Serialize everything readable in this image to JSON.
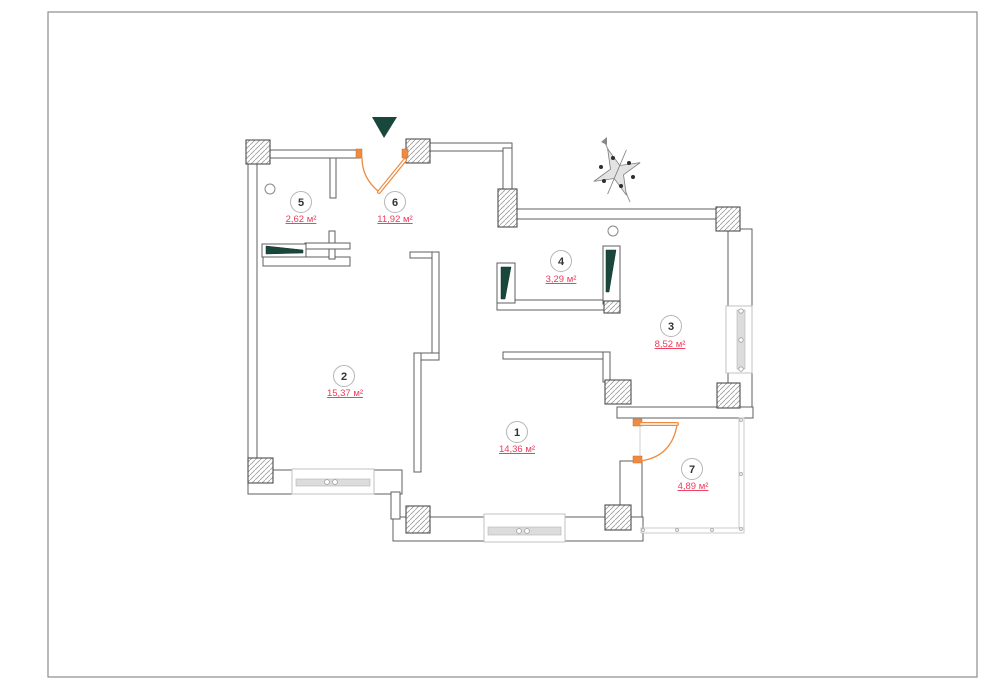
{
  "document": {
    "kind": "apartment floor plan",
    "sheet": "blank sheet with thin border, no title block"
  },
  "rooms": [
    {
      "number": "1",
      "area": "14,36 м²"
    },
    {
      "number": "2",
      "area": "15,37 м²"
    },
    {
      "number": "3",
      "area": "8,52 м²"
    },
    {
      "number": "4",
      "area": "3,29 м²"
    },
    {
      "number": "5",
      "area": "2,62 м²"
    },
    {
      "number": "6",
      "area": "11,92 м²"
    },
    {
      "number": "7",
      "area": "4,89 м²"
    }
  ],
  "colors": {
    "area_text": "#ee3a5c",
    "door": "#ef8b40",
    "marker": "#1a473c",
    "wall_line": "#5f5f5f"
  },
  "icons": {
    "entrance_marker": "dark teal triangle pointing down at entrance door",
    "compass_rose": "gray star compass with dark dots, needle to upper-left",
    "sliding_doors": "dark teal tapered wedges in wall pockets",
    "swing_doors": "orange quarter-arc doors"
  }
}
